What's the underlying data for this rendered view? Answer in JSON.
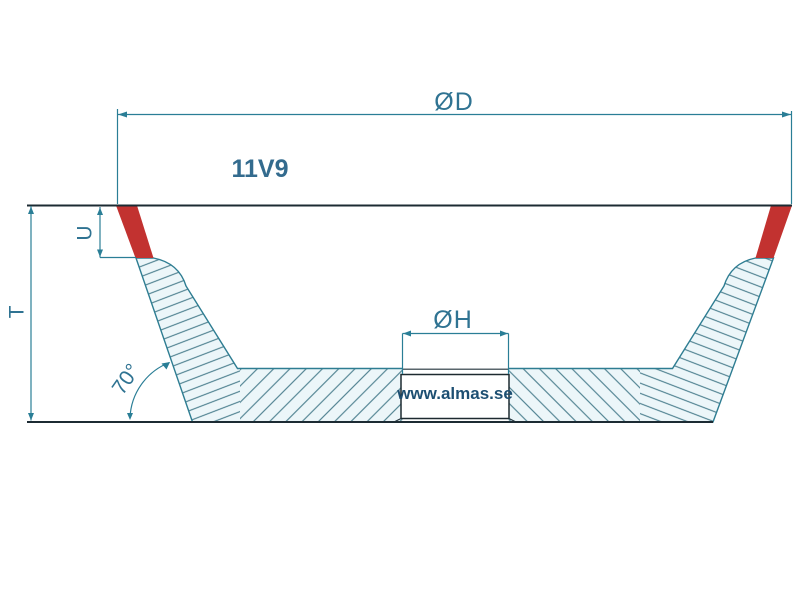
{
  "drawing": {
    "title": "Grinding wheel profile drawing",
    "model_label": "11V9",
    "watermark": "www.almas.se",
    "dimensions": {
      "outer_diameter_label": "ØD",
      "bore_diameter_label": "ØH",
      "total_height_label": "T",
      "rim_depth_label": "U",
      "wall_angle_label": "70°"
    },
    "colors": {
      "dimension_line": "#2a7e96",
      "label_text": "#2f7392",
      "model_text": "#336b8e",
      "watermark_text": "#1d4f72",
      "abrasive_red": "#c23230",
      "hatch_line": "#3a7283",
      "hatch_background": "#ecf6f9",
      "outline_dark": "#1c2b33"
    }
  }
}
